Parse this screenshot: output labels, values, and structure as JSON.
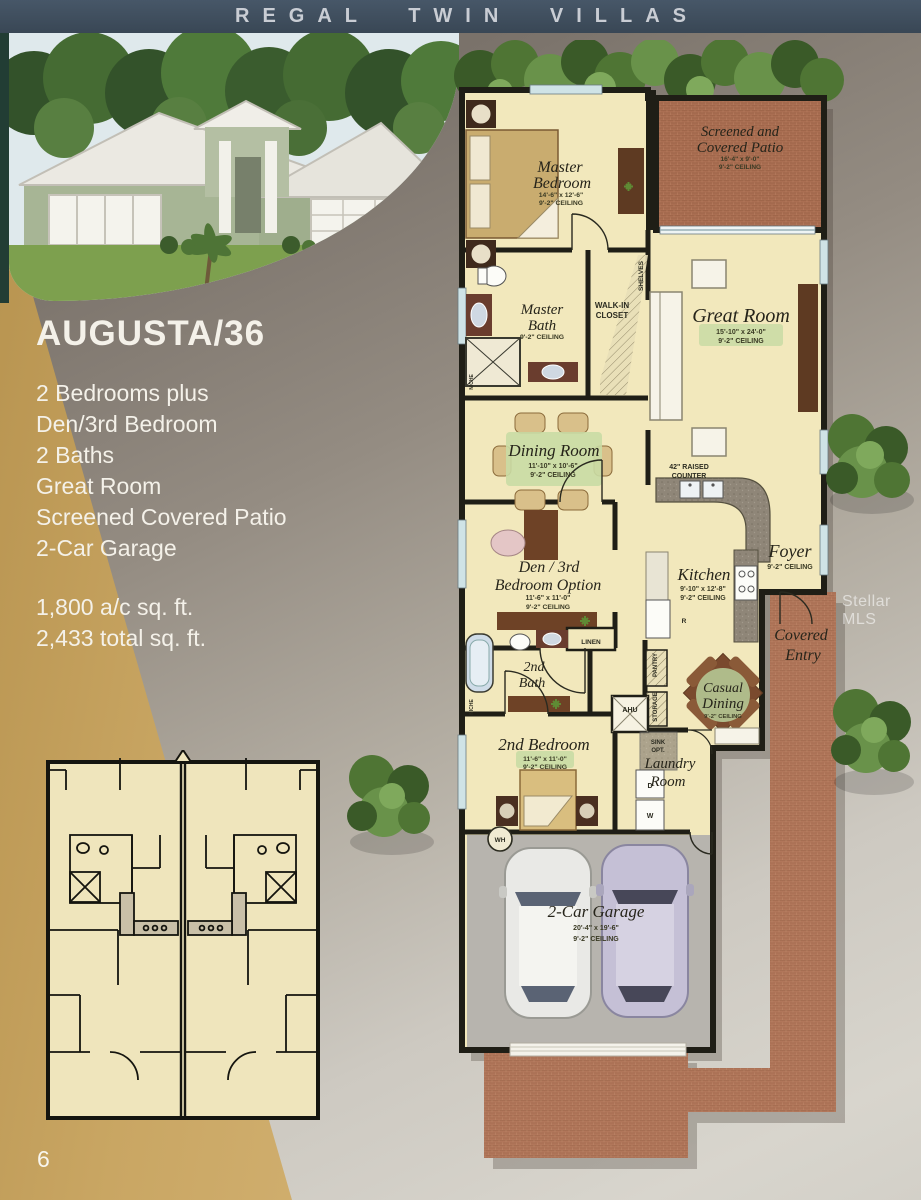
{
  "banner": {
    "title": "REGAL TWIN VILLAS"
  },
  "model": {
    "name": "AUGUSTA/36",
    "features": [
      "2 Bedrooms plus",
      "Den/3rd Bedroom",
      "2 Baths",
      "Great Room",
      "Screened Covered Patio",
      "2-Car Garage"
    ],
    "area": [
      "1,800 a/c sq. ft.",
      "2,433 total sq. ft."
    ]
  },
  "page": {
    "number": "6",
    "watermark": "Stellar MLS"
  },
  "rooms": {
    "master_bedroom": {
      "line1": "Master",
      "line2": "Bedroom",
      "dims": "14'-6\" x 12'-6\"",
      "ceiling": "9'-2\" CEILING"
    },
    "patio": {
      "line1": "Screened and",
      "line2": "Covered Patio",
      "dims": "16'-4\" x 9'-0\"",
      "ceiling": "9'-2\" CEILING"
    },
    "master_bath": {
      "line1": "Master",
      "line2": "Bath",
      "ceiling": "9'-2\" CEILING"
    },
    "walk_in_closet": {
      "line1": "WALK-IN",
      "line2": "CLOSET"
    },
    "great_room": {
      "name": "Great Room",
      "dims": "15'-10\" x 24'-0\"",
      "ceiling": "9'-2\" CEILING"
    },
    "dining_room": {
      "name": "Dining Room",
      "dims": "11'-10\" x 10'-6\"",
      "ceiling": "9'-2\" CEILING"
    },
    "raised_counter": {
      "line1": "42\" RAISED",
      "line2": "COUNTER"
    },
    "foyer": {
      "name": "Foyer",
      "ceiling": "9'-2\" CEILING"
    },
    "den": {
      "line1": "Den / 3rd",
      "line2": "Bedroom Option",
      "dims": "11'-6\" x 11'-0\"",
      "ceiling": "9'-2\" CEILING"
    },
    "kitchen": {
      "name": "Kitchen",
      "dims": "9'-10\" x 12'-8\"",
      "ceiling": "9'-2\" CEILING"
    },
    "second_bath": {
      "line1": "2nd",
      "line2": "Bath"
    },
    "casual_dining": {
      "line1": "Casual",
      "line2": "Dining",
      "ceiling": "9'-2\" CEILING"
    },
    "second_bedroom": {
      "name": "2nd Bedroom",
      "dims": "11'-6\" x 11'-0\"",
      "ceiling": "9'-2\" CEILING"
    },
    "laundry": {
      "line1": "Laundry",
      "line2": "Room"
    },
    "covered_entry": {
      "line1": "Covered",
      "line2": "Entry"
    },
    "garage": {
      "name": "2-Car Garage",
      "dims": "20'-4\" x 19'-6\"",
      "ceiling": "9'-2\" CEILING"
    }
  },
  "labels": {
    "shelves": "SHELVES",
    "linen": "LINEN",
    "ahu": "AHU",
    "pantry": "PANTRY",
    "storage": "STORAGE",
    "sink_opt": {
      "line1": "SINK",
      "line2": "OPT."
    },
    "niche": "NICHE",
    "wh": "WH",
    "washer": "W",
    "dryer": "D",
    "refrigerator": "R"
  },
  "colors": {
    "banner_bg": "#3d4b5a",
    "tan": "#c8a765",
    "brick": "#b1765a",
    "plan_cream": "#f2e8bc",
    "wall": "#1f1e16",
    "label_green": "#c9dba4",
    "garage_floor": "#b7b4ae"
  }
}
